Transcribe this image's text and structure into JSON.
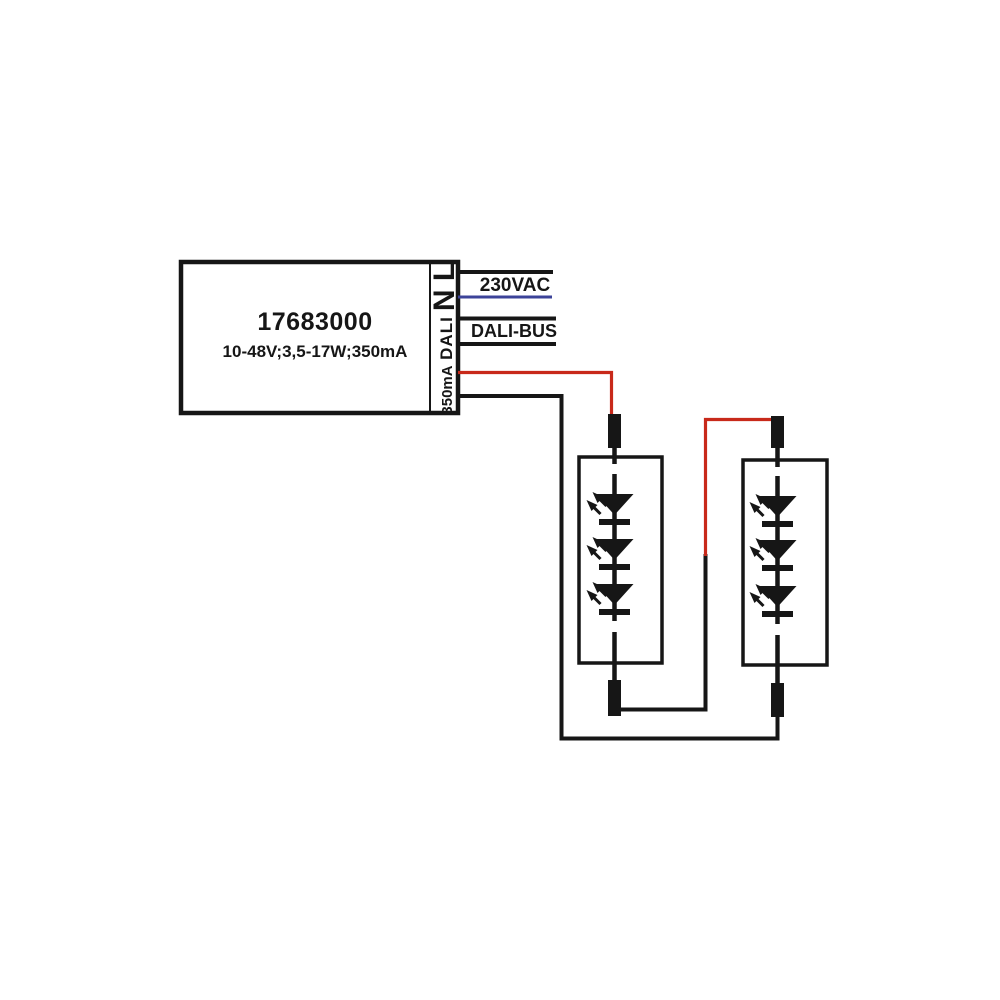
{
  "page": {
    "kind": "wiring-diagram",
    "description": "DALI LED driver connection diagram with two series LED modules"
  },
  "driver": {
    "model": "17683000",
    "spec": "10-48V;3,5-17W;350mA",
    "terminal_mains": "N L",
    "terminal_dali": "DALI",
    "terminal_output": "350mA"
  },
  "labels": {
    "mains_bus": "230VAC",
    "dali_bus": "DALI-BUS"
  },
  "modules": [
    {
      "name": "led-module-1",
      "led_count": 3
    },
    {
      "name": "led-module-2",
      "led_count": 3
    }
  ],
  "colors": {
    "line": "#161616",
    "neutral": "#3c4399",
    "positive": "#c8291a",
    "background": "#ffffff"
  }
}
